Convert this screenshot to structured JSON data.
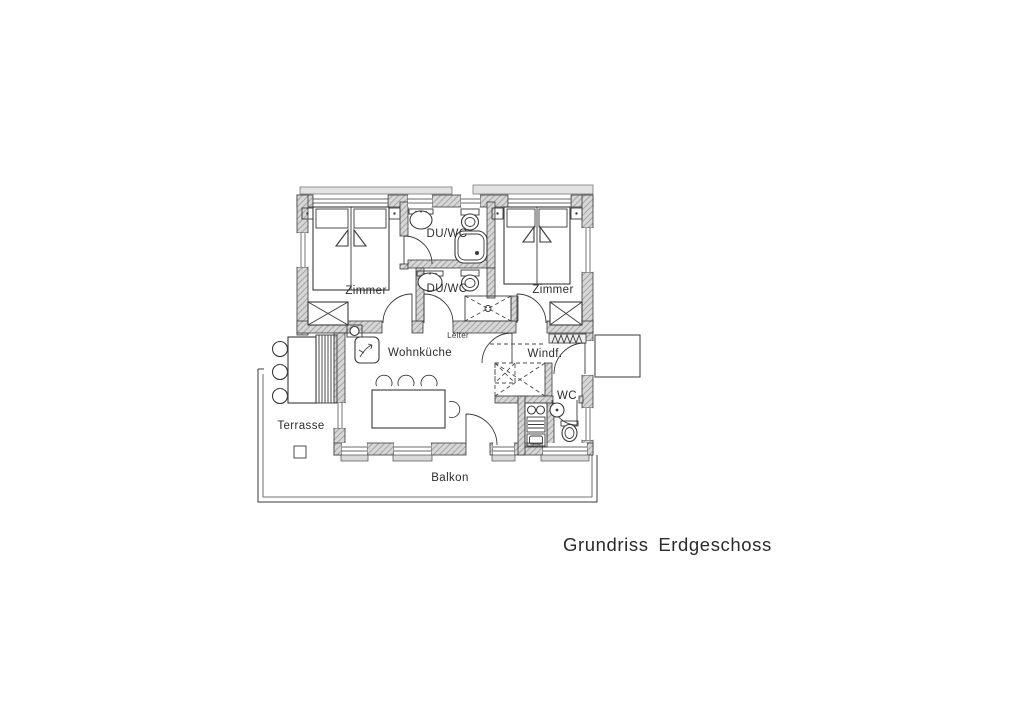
{
  "title": "Grundriss Erdgeschoss",
  "floorplan": {
    "rooms": {
      "zimmer_left": "Zimmer",
      "duwc_upper": "DU/WC",
      "duwc_lower": "DU/WC",
      "zimmer_right": "Zimmer",
      "wohnkueche": "Wohnküche",
      "windfang": "Windf.",
      "wc": "WC",
      "terrasse": "Terrasse",
      "balkon": "Balkon"
    },
    "annotations": {
      "leiter": "Leiter"
    },
    "colors": {
      "wall_fill": "#d7d7d7",
      "line": "#3a3a3a",
      "paper": "#ffffff"
    }
  }
}
